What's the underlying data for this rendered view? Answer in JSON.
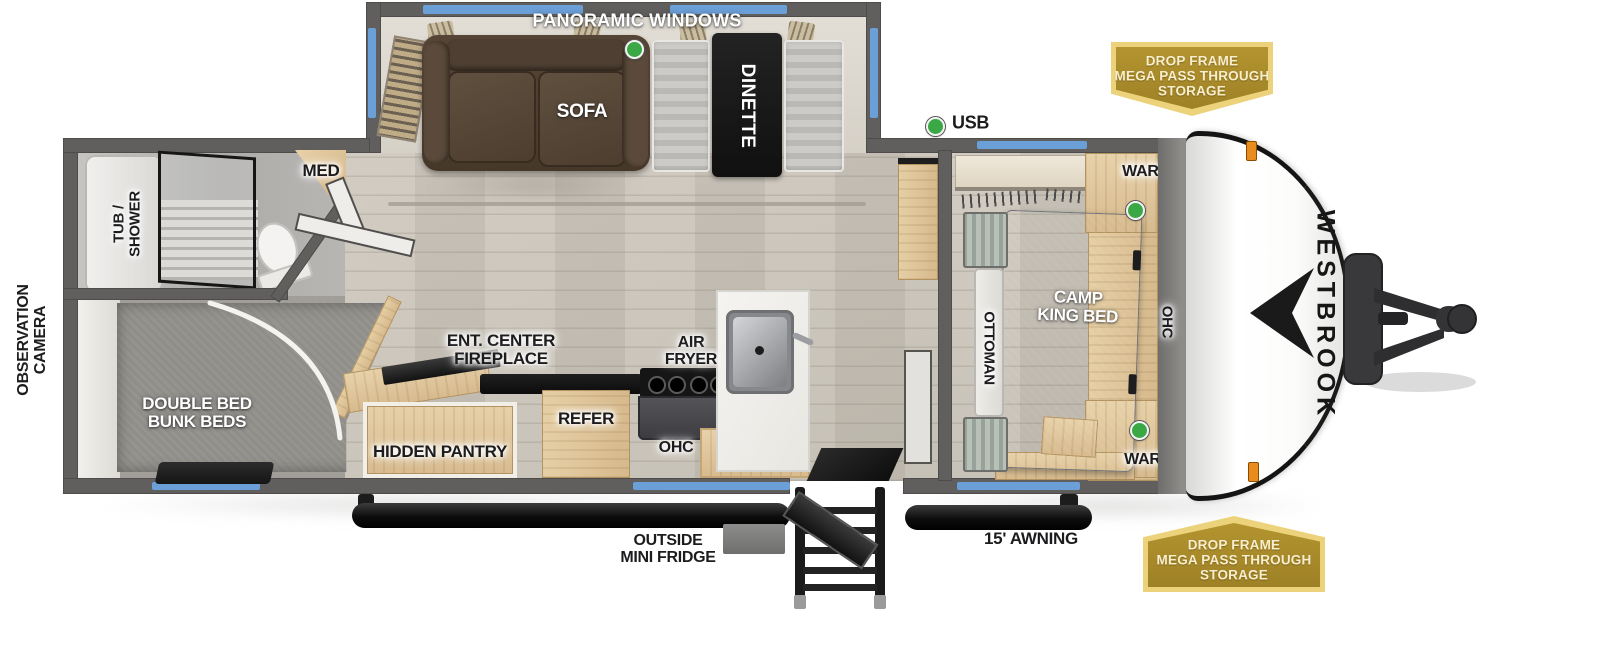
{
  "brand": {
    "wordmark": "WESTBROOK"
  },
  "badges": {
    "drop_frame_top": "DROP FRAME\nMEGA PASS THROUGH\nSTORAGE",
    "drop_frame_bottom": "DROP FRAME\nMEGA PASS THROUGH\nSTORAGE"
  },
  "labels": {
    "panoramic_windows": "PANORAMIC WINDOWS",
    "sofa": "SOFA",
    "dinette": "DINETTE",
    "usb": "USB",
    "med": "MED",
    "tub_shower": "TUB /\nSHOWER",
    "observation_camera": "OBSERVATION\nCAMERA",
    "double_bed_bunk_beds": "DOUBLE BED\nBUNK BEDS",
    "ent_center_fireplace": "ENT. CENTER\nFIREPLACE",
    "hidden_pantry": "HIDDEN PANTRY",
    "refer": "REFER",
    "ohc_kitchen": "OHC",
    "air_fryer": "AIR\nFRYER",
    "outside_mini_fridge": "OUTSIDE\nMINI FRIDGE",
    "awning": "15' AWNING",
    "ward_top": "WARD",
    "ward_bottom": "WARD",
    "ottoman": "OTTOMAN",
    "camp_king_bed": "CAMP\nKING BED",
    "ohc_bedroom": "OHC"
  },
  "colors": {
    "window_accent": "#6b9fd8",
    "led_green": "#3aa845",
    "wall_gray": "#605f5d",
    "badge_gold": "#a8892c",
    "badge_border": "#ecd27a",
    "wood": "#ddc096",
    "bed_gray": "#8b8f95"
  }
}
